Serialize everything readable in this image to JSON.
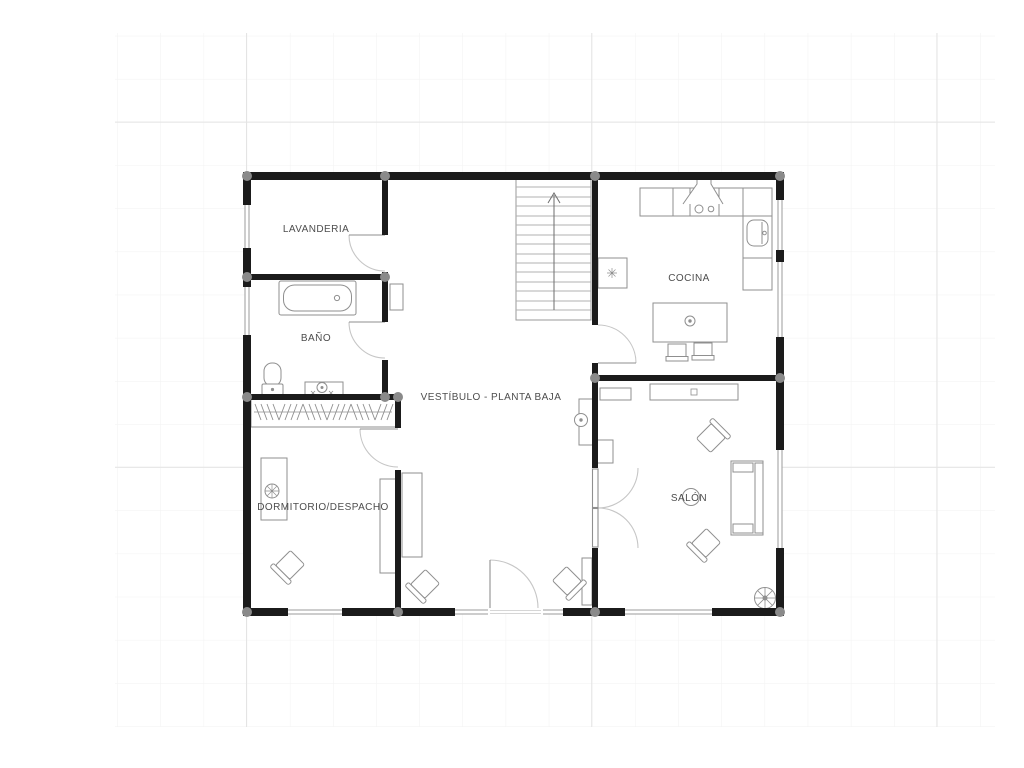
{
  "plan": {
    "title_note": "floor plan drawing",
    "rooms": {
      "lavanderia": "LAVANDERIA",
      "bano": "BAÑO",
      "cocina": "COCINA",
      "vestibulo": "VESTÍBULO - PLANTA BAJA",
      "dormitorio": "DORMITORIO/DESPACHO",
      "salon": "SALÓN"
    },
    "colors": {
      "background": "#ffffff",
      "wall": "#1b1b1b",
      "column": "#8a8a8a",
      "furniture": "#8f8f8f",
      "door_arc": "#c6c6c6",
      "stair_tread": "#b0b0b0",
      "window_line": "#9b9b9b",
      "label_text": "#4d4d4d",
      "grid_minor": "#f2f2f2",
      "grid_major": "#e4e4e4"
    }
  }
}
